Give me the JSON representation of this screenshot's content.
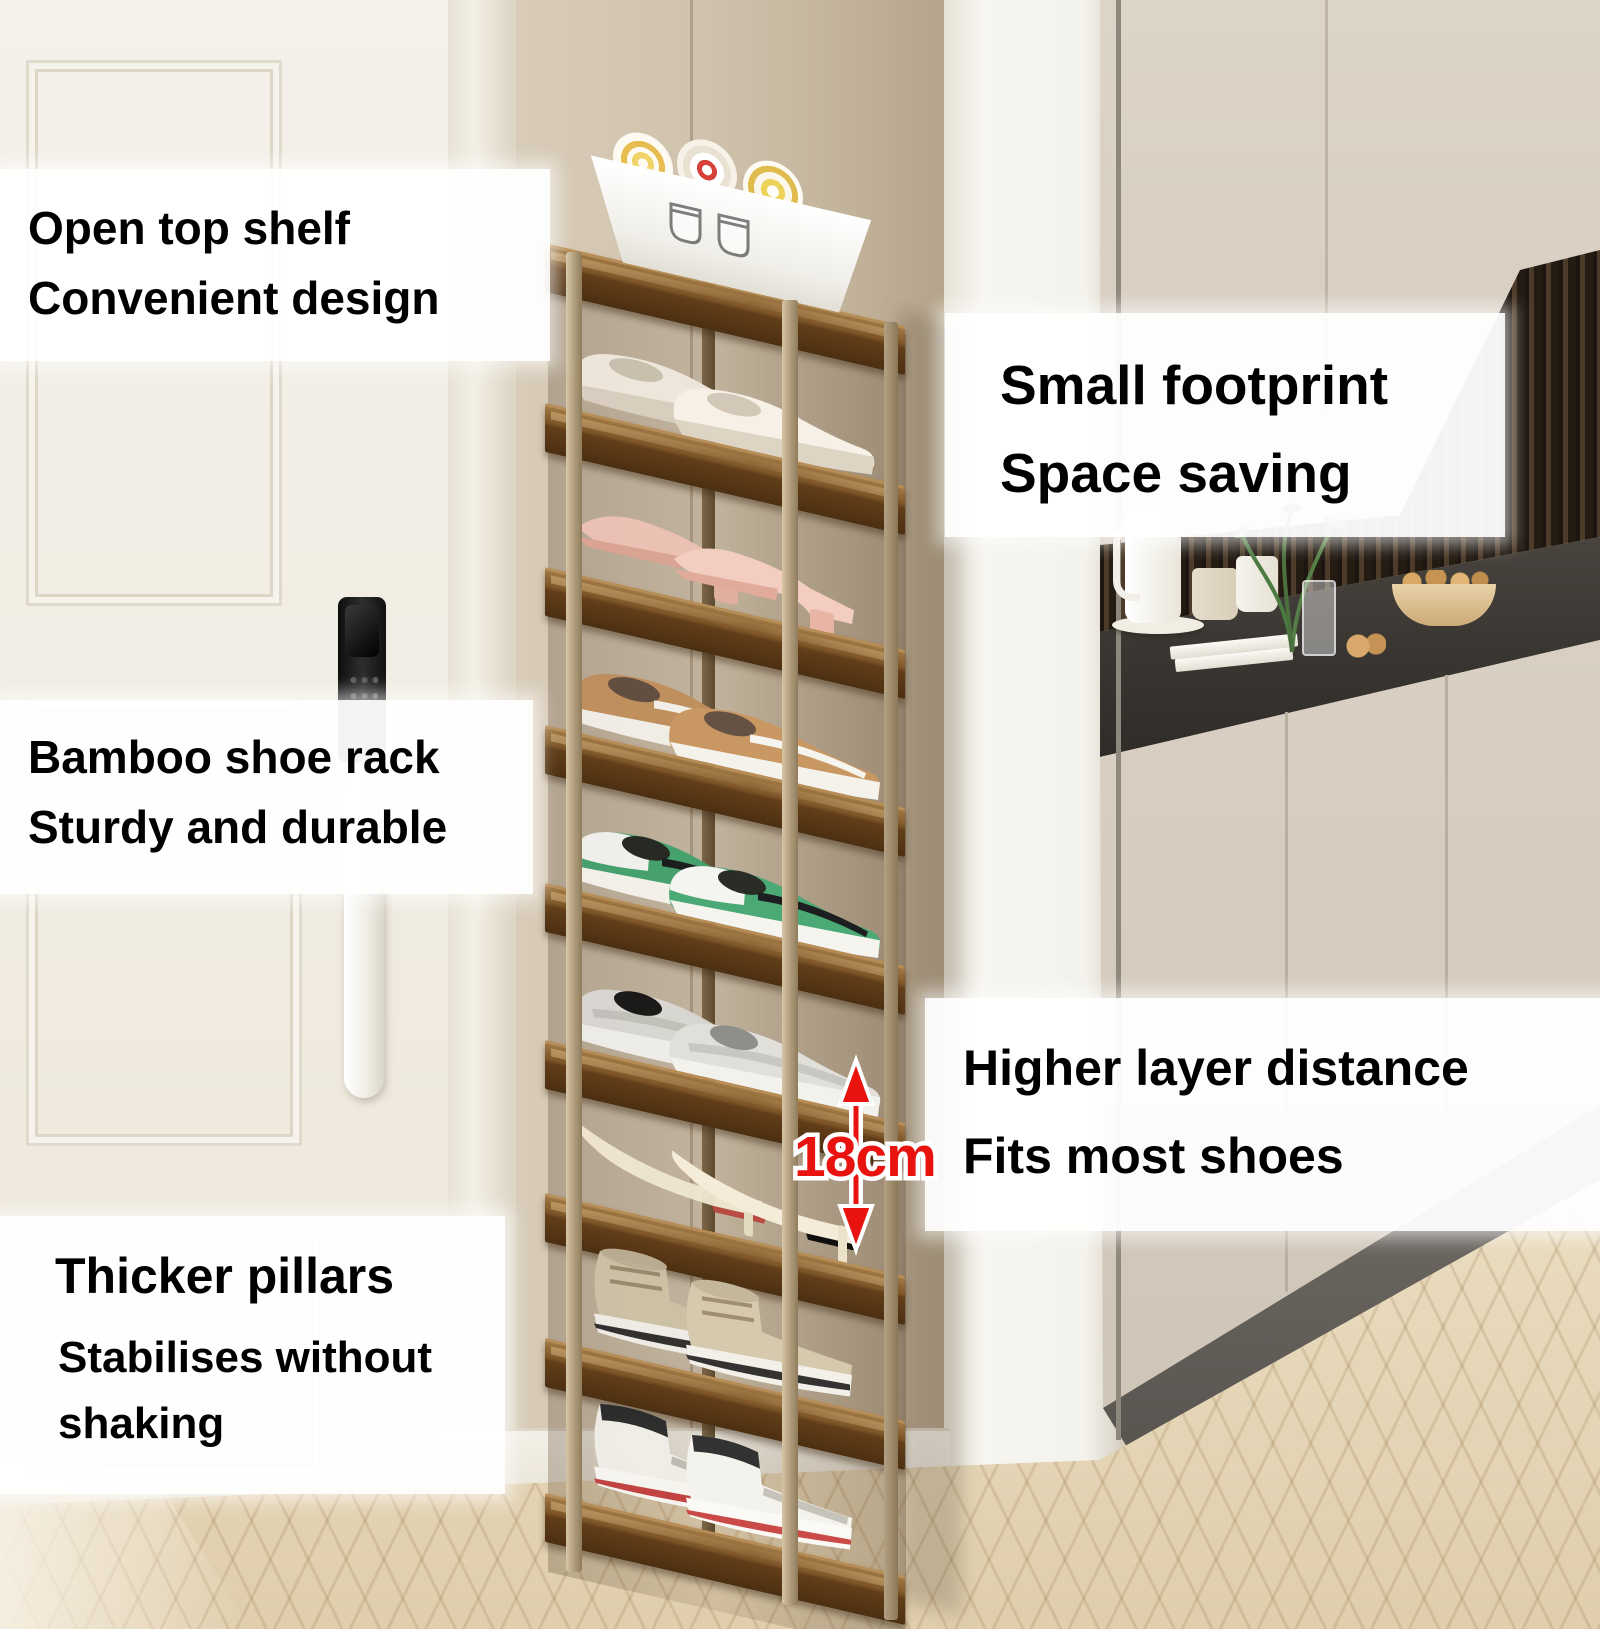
{
  "annotations": {
    "open_top": {
      "line1": "Open top shelf",
      "line2": "Convenient design"
    },
    "small_footprint": {
      "line1": "Small footprint",
      "line2": "Space saving"
    },
    "bamboo": {
      "line1": "Bamboo shoe rack",
      "line2": "Sturdy and durable"
    },
    "layer_distance": {
      "line1": "Higher layer distance",
      "line2": "Fits most shoes"
    },
    "pillars": {
      "line1": "Thicker pillars",
      "line2": "Stabilises without",
      "line3": "shaking"
    }
  },
  "measurement": {
    "layer_height": "18cm"
  },
  "rack": {
    "tier_count": 9,
    "tiers": [
      "towel-basket",
      "white-flats",
      "pink-heeled-mules",
      "tan-sneakers",
      "green-sneakers",
      "knit-sneakers",
      "cream-high-heels",
      "beige-high-top-boots",
      "white-high-top-sneakers"
    ]
  },
  "colors": {
    "accent_red": "#e8120e",
    "wood_dark": "#5f3f1f",
    "wood_light": "#8a6134",
    "post_light": "#c4b291",
    "wall_beige": "#d5c9b6",
    "floor": "#e6d7ba",
    "annotation_bg": "#ffffff",
    "annotation_text": "#000000"
  }
}
